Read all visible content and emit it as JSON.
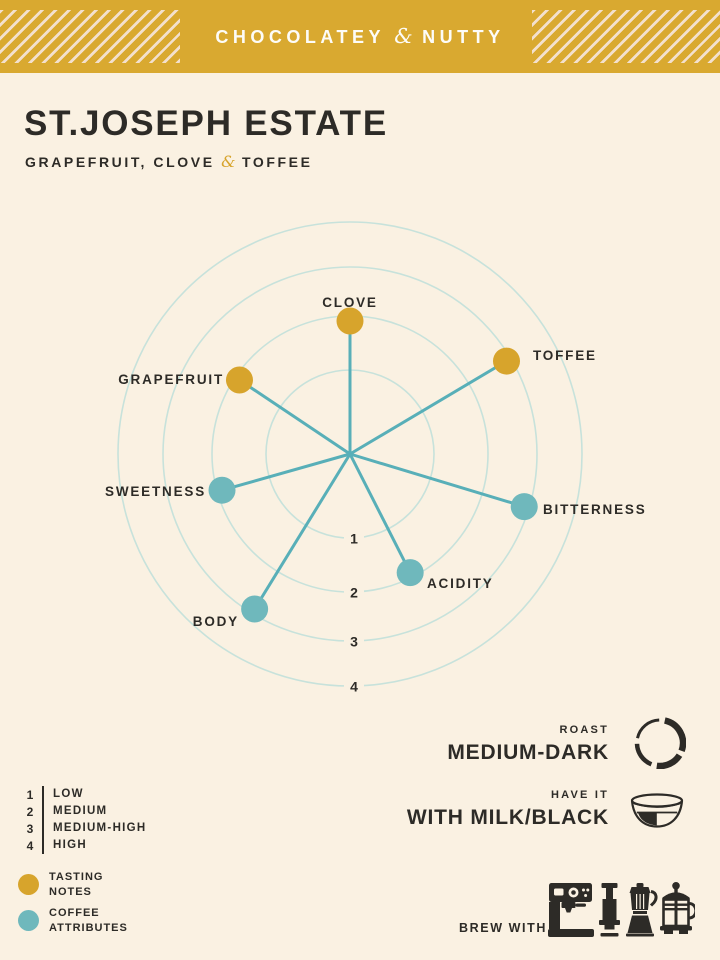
{
  "banner": {
    "pre": "CHOCOLATEY",
    "amp": "&",
    "post": "NUTTY"
  },
  "header": {
    "title": "ST.JOSEPH ESTATE",
    "flavor_pre": "GRAPEFRUIT, CLOVE",
    "flavor_amp": "&",
    "flavor_post": "TOFFEE"
  },
  "chart_data": {
    "type": "radar",
    "title": "",
    "scale": {
      "min": 1,
      "max": 4,
      "ring_labels": [
        "1",
        "2",
        "3",
        "4"
      ],
      "scale_meaning": {
        "1": "LOW",
        "2": "MEDIUM",
        "3": "MEDIUM-HIGH",
        "4": "HIGH"
      }
    },
    "axes": [
      {
        "label": "CLOVE",
        "value": 2,
        "group": "tasting_note"
      },
      {
        "label": "TOFFEE",
        "value": 3,
        "group": "tasting_note"
      },
      {
        "label": "BITTERNESS",
        "value": 3,
        "group": "attribute"
      },
      {
        "label": "ACIDITY",
        "value": 2,
        "group": "attribute"
      },
      {
        "label": "BODY",
        "value": 3,
        "group": "attribute"
      },
      {
        "label": "SWEETNESS",
        "value": 2,
        "group": "attribute"
      },
      {
        "label": "GRAPEFRUIT",
        "value": 2,
        "group": "tasting_note"
      }
    ],
    "colors": {
      "tasting_note": "#D7A42C",
      "attribute": "#6FB8BC",
      "spoke": "#58AFB8",
      "ring": "#C7E2DB",
      "label": "#2D2B27"
    },
    "layout": {
      "center": [
        350,
        454
      ],
      "ring_radii": [
        84,
        138,
        187,
        232
      ],
      "angles_deg": [
        -90,
        -30.7,
        16.8,
        63.1,
        121.6,
        164.2,
        213.8
      ],
      "dot_inset": 5,
      "dot_radius": 13.5,
      "grid": "circular",
      "labels": [
        {
          "x": 350,
          "y": 307,
          "anchor": "middle"
        },
        {
          "x": 533,
          "y": 360,
          "anchor": "start"
        },
        {
          "x": 543,
          "y": 514,
          "anchor": "start"
        },
        {
          "x": 427,
          "y": 588,
          "anchor": "start"
        },
        {
          "x": 239,
          "y": 626,
          "anchor": "end"
        },
        {
          "x": 206,
          "y": 496,
          "anchor": "end"
        },
        {
          "x": 224,
          "y": 384,
          "anchor": "end"
        }
      ]
    }
  },
  "roast": {
    "label": "ROAST",
    "value": "MEDIUM-DARK"
  },
  "have_it": {
    "label": "HAVE IT",
    "value": "WITH MILK/BLACK"
  },
  "legend": {
    "scale": [
      {
        "num": "1",
        "label": "LOW"
      },
      {
        "num": "2",
        "label": "MEDIUM"
      },
      {
        "num": "3",
        "label": "MEDIUM-HIGH"
      },
      {
        "num": "4",
        "label": "HIGH"
      }
    ],
    "keys": [
      {
        "name": "tasting-notes",
        "lines": [
          "TASTING",
          "NOTES"
        ],
        "color": "#D7A42C"
      },
      {
        "name": "coffee-attributes",
        "lines": [
          "COFFEE",
          "ATTRIBUTES"
        ],
        "color": "#6FB8BC"
      }
    ]
  },
  "brew": {
    "label": "BREW WITH",
    "methods": [
      "espresso-machine",
      "aeropress",
      "moka-pot",
      "french-press"
    ]
  },
  "colors": {
    "background": "#FAF1E2",
    "banner_gold": "#D9A930",
    "stripe": "#F3E0CD",
    "ink": "#2D2B27"
  }
}
